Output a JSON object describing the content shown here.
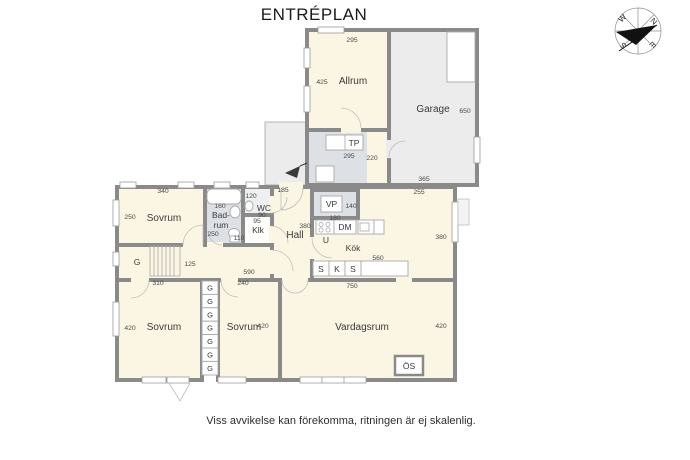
{
  "title": "ENTRÉPLAN",
  "disclaimer": "Viss avvikelse kan förekomma, ritningen är ej skalenlig.",
  "compass": {
    "n": "N",
    "e": "E",
    "s": "S",
    "w": "W"
  },
  "colors": {
    "room_fill": "#FBF6E4",
    "garage_fill": "#ECECEC",
    "wet_fill": "#DDE0E4",
    "wall": "#8A8A8A"
  },
  "rooms": {
    "allrum": "Allrum",
    "garage": "Garage",
    "tp": "TP",
    "vp": "VP",
    "dm": "DM",
    "oven": "U",
    "kok": "Kök",
    "hall": "Hall",
    "wc": "WC",
    "klk": "Klk",
    "badrum1": "Bad-",
    "badrum2": "rum",
    "sovrum_nw": "Sovrum",
    "sovrum_sw": "Sovrum",
    "sovrum_s": "Sovrum",
    "vardagsrum": "Vardagsrum",
    "os": "ÖS",
    "g": "G"
  },
  "bench": [
    "S",
    "K",
    "S"
  ],
  "wardrobes": [
    "G",
    "G",
    "G",
    "G",
    "G",
    "G",
    "G"
  ],
  "dims": {
    "allrum_top": "295",
    "allrum_left": "425",
    "garage_right": "650",
    "garage_bottom": "365",
    "tp_bottom": "295",
    "tp_right": "220",
    "porch_top": "185",
    "kok_top": "255",
    "kok_right": "380",
    "sovrum_nw_top": "340",
    "sovrum_nw_left": "250",
    "badrum_top": "160",
    "badrum_left": "250",
    "wc_top": "120",
    "wc_bottom": "90",
    "klk_top": "95",
    "klk_left": "110",
    "hall_right": "380",
    "vp_right": "140",
    "vp_bottom": "180",
    "stair": "125",
    "corridor": "590",
    "sovrum_sw_top": "310",
    "sovrum_s_top": "240",
    "bench": "560",
    "vardagsrum_top": "750",
    "sovrum_sw_left": "420",
    "sovrum_s_right": "420",
    "vardagsrum_right": "420"
  }
}
